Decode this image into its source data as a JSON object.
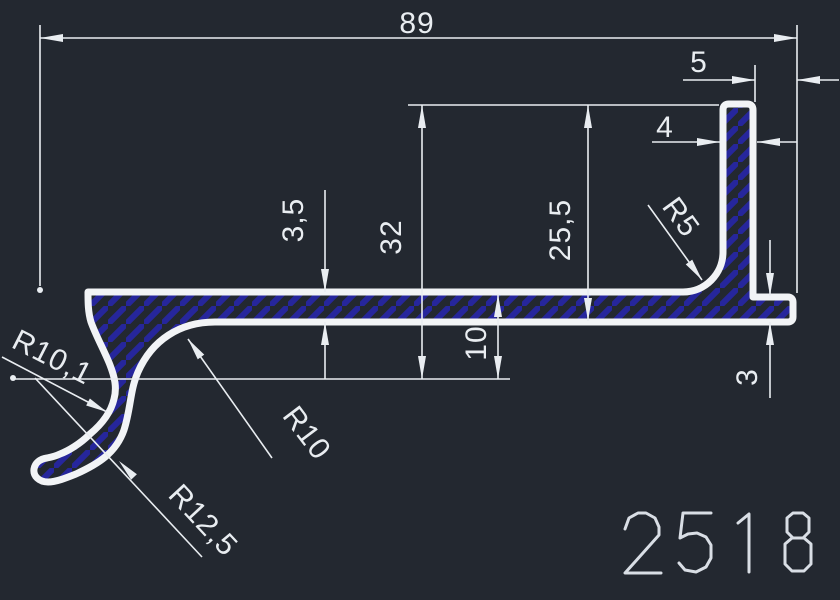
{
  "drawing": {
    "part_number": "2518",
    "dimensions": {
      "overall_width": "89",
      "right_lip_offset": "5",
      "flange_thickness": "4",
      "web_thickness": "3,5",
      "overall_height": "32",
      "flange_height": "25,5",
      "web_to_centerline": "10",
      "lip_thickness": "3",
      "fillet_radius": "R5",
      "inner_fillet_radius": "R10",
      "hook_inner_radius": "R10,1",
      "hook_outer_radius": "R12,5"
    },
    "colors": {
      "background": "#232830",
      "outline": "#f2f4f6",
      "dimension": "#e9edf1",
      "hatch": "#26269c",
      "part_number": "#d9dee5"
    }
  }
}
